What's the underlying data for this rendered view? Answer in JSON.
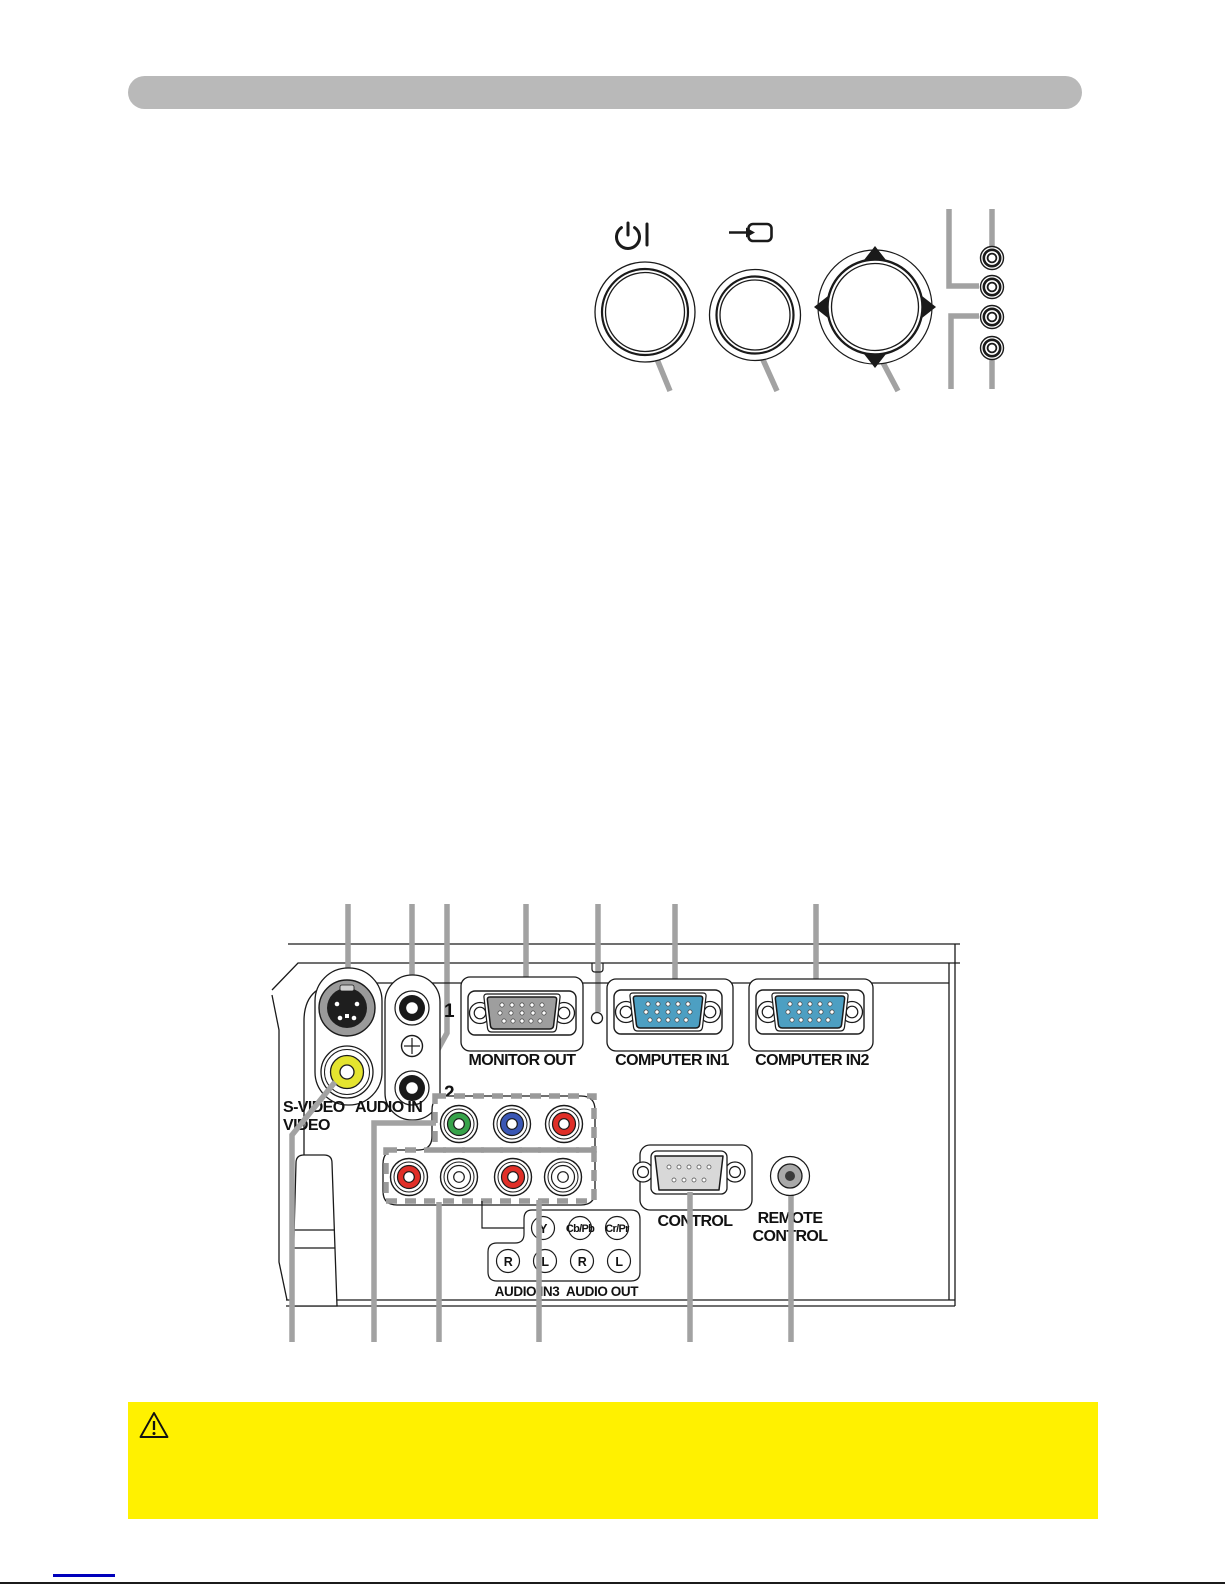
{
  "document": {
    "kind": "projector-manual-page",
    "header_bar_text": "",
    "colors": {
      "header_gray": "#b9b9b9",
      "callout_gray": "#a2a2a2",
      "warning_yellow": "#fff100",
      "link_blue": "#0000bb",
      "vga_monitor_gray": "#9e9e9e",
      "vga_computer_blue": "#4d9fc2",
      "jack_yellow": "#e4e42f",
      "component_green": "#37a34a",
      "component_blue": "#3a57b5",
      "component_red": "#e02f28",
      "db9_gray": "#d8d8d8"
    }
  },
  "control_panel_diagram": {
    "buttons": [
      {
        "name": "standby-on-button",
        "icon": "power-icon"
      },
      {
        "name": "input-button",
        "icon": "input-arrow-icon"
      },
      {
        "name": "directional-pad",
        "icons": [
          "triangle-up-icon",
          "triangle-left-icon",
          "triangle-right-icon",
          "triangle-down-icon"
        ]
      }
    ],
    "led_count": 4
  },
  "rear_panel_diagram": {
    "ports": {
      "s_video": "S-VIDEO",
      "video": "VIDEO",
      "audio_in": "AUDIO IN",
      "audio_in_1": "1",
      "audio_in_2": "2",
      "monitor_out": "MONITOR OUT",
      "computer_in1": "COMPUTER IN1",
      "computer_in2": "COMPUTER IN2",
      "component_y": "Y",
      "component_cb_pb": "Cb/Pb",
      "component_cr_pr": "Cr/Pr",
      "audio_right": "R",
      "audio_left": "L",
      "audio_in3": "AUDIO IN3",
      "audio_out": "AUDIO OUT",
      "control": "CONTROL",
      "remote_control_line1": "REMOTE",
      "remote_control_line2": "CONTROL",
      "kensington": "K"
    },
    "icons": [
      "kensington-lock-icon"
    ]
  },
  "warning_box": {
    "icon": "warning-triangle-icon",
    "text": ""
  }
}
